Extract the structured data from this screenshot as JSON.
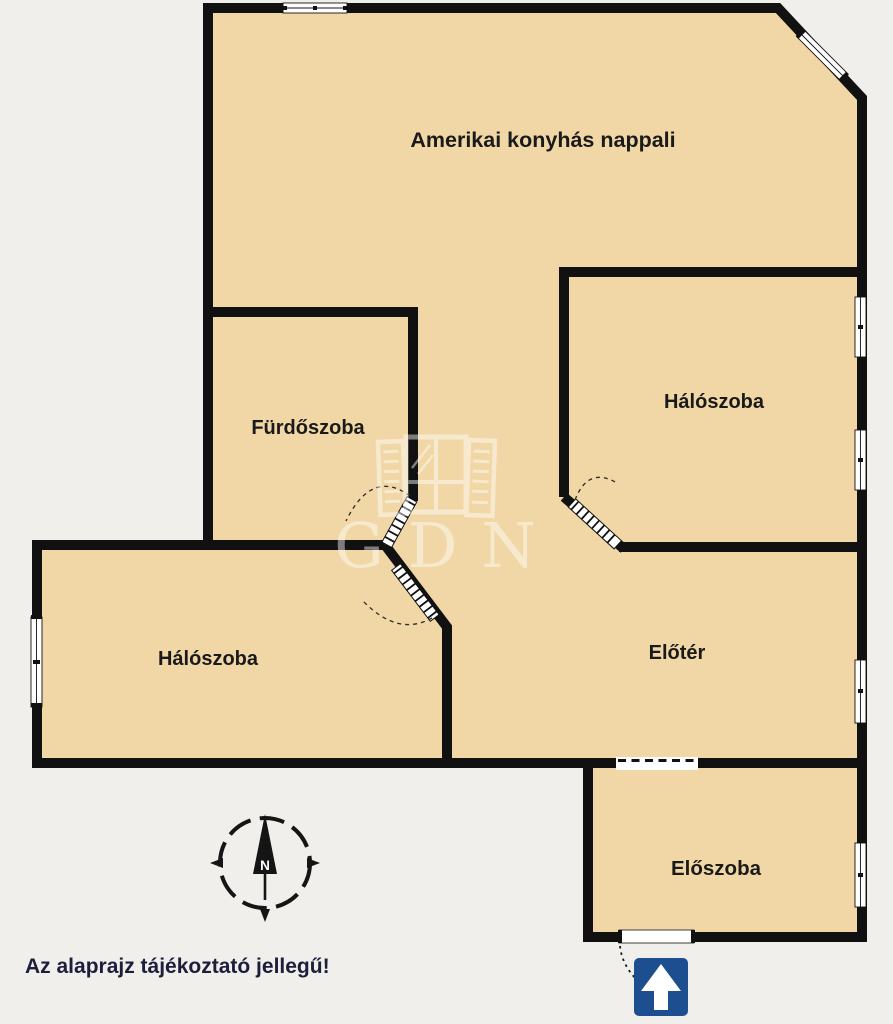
{
  "colors": {
    "background": "#f0efeb",
    "floor": "#f2d7a6",
    "wall": "#111111",
    "window": "#ffffff",
    "entrance_sign": "#1d4e8f",
    "label_text": "#1a1a1a",
    "note_text": "#1d1d3c",
    "watermark": "#ffffff"
  },
  "rooms": {
    "living": {
      "label": "Amerikai konyhás nappali"
    },
    "bathroom": {
      "label": "Fürdőszoba"
    },
    "bedroom_right": {
      "label": "Hálószoba"
    },
    "bedroom_left": {
      "label": "Hálószoba"
    },
    "hall": {
      "label": "Előtér"
    },
    "entry": {
      "label": "Előszoba"
    }
  },
  "compass": {
    "north_label": "N"
  },
  "watermark": {
    "text": "GDN"
  },
  "note": {
    "text": "Az alaprajz tájékoztató jellegű!"
  }
}
